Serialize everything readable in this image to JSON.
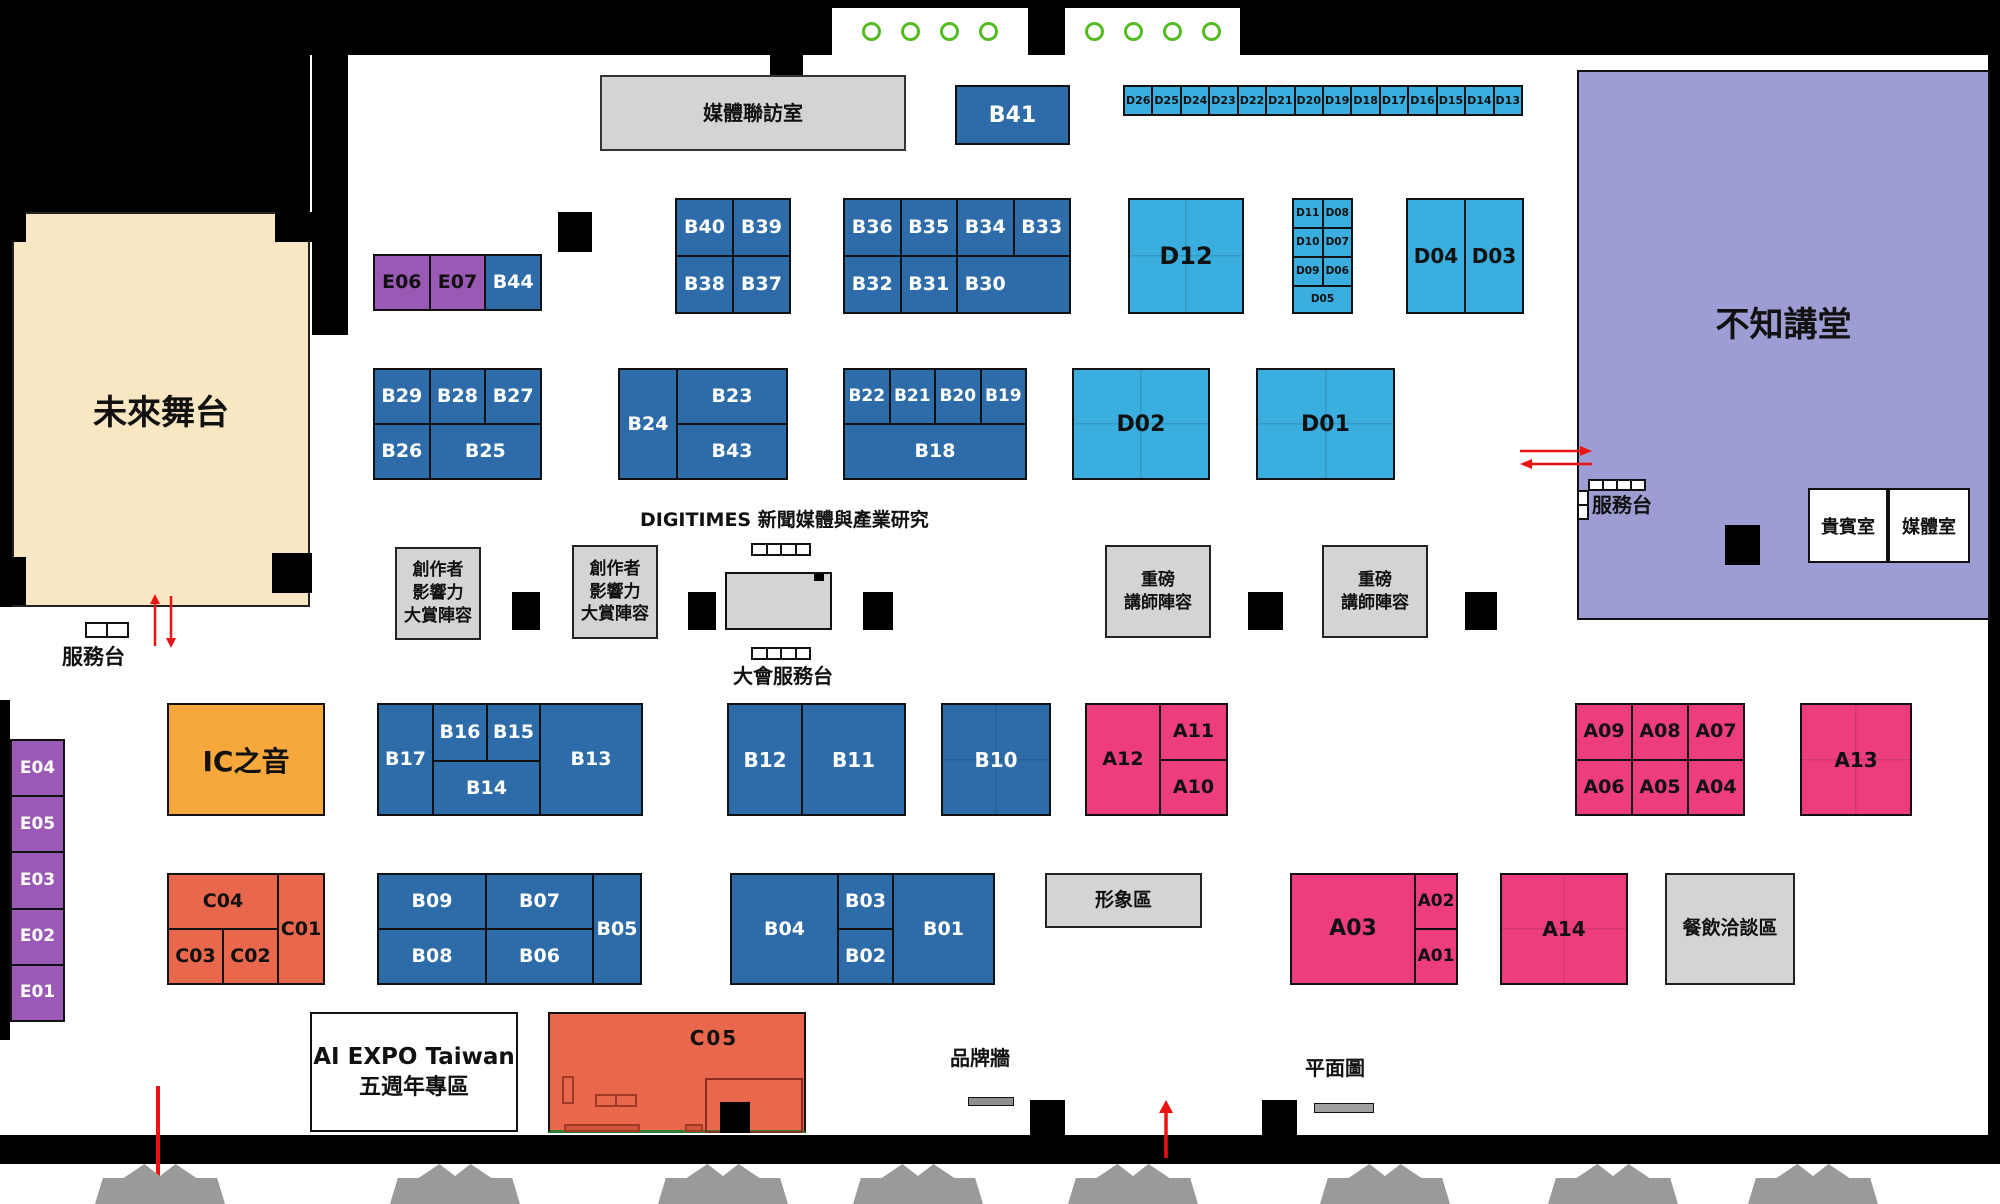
{
  "rooms": {
    "media_interview_room": "媒體聯訪室",
    "future_stage": "未來舞台",
    "lecture_hall": "不知講堂",
    "vip_room": "貴賓室",
    "media_room": "媒體室",
    "service_desk": "服務台",
    "hall_service_desk": "服務台",
    "main_service_desk": "大會服務台",
    "digitimes_area": "DIGITIMES 新聞媒體與產業研究",
    "creator_award_lines": [
      "創作者",
      "影響力",
      "大賞陣容"
    ],
    "keynote_speaker_lines": [
      "重磅",
      "講師陣容"
    ],
    "ic_voice": "IC之音",
    "image_area": "形象區",
    "dining_area": "餐飲洽談區",
    "anniversary_lines": [
      "AI EXPO Taiwan",
      "五週年專區"
    ],
    "brand_wall": "品牌牆",
    "floor_plan": "平面圖"
  },
  "booths": {
    "d_strip": [
      "D26",
      "D25",
      "D24",
      "D23",
      "D22",
      "D21",
      "D20",
      "D19",
      "D18",
      "D17",
      "D16",
      "D15",
      "D14",
      "D13"
    ],
    "b41": "B41",
    "b40_block": [
      "B40",
      "B39",
      "B38",
      "B37"
    ],
    "b36_block": [
      "B36",
      "B35",
      "B34",
      "B33",
      "B32",
      "B31",
      "B30"
    ],
    "d12": "D12",
    "d_mini": [
      "D11",
      "D08",
      "D10",
      "D07",
      "D09",
      "D06",
      "D05"
    ],
    "d04_block": [
      "D04",
      "D03"
    ],
    "e_row": [
      "E06",
      "E07",
      "B44"
    ],
    "b29_block": [
      "B29",
      "B28",
      "B27",
      "B26",
      "B25"
    ],
    "b24_block": [
      "B24",
      "B23",
      "B43"
    ],
    "b22_block": [
      "B22",
      "B21",
      "B20",
      "B19",
      "B18"
    ],
    "d02": "D02",
    "d01": "D01",
    "b17_block": [
      "B17",
      "B16",
      "B15",
      "B14",
      "B13"
    ],
    "b12_block": [
      "B12",
      "B11"
    ],
    "b10": "B10",
    "a12_block": [
      "A12",
      "A11",
      "A10"
    ],
    "a09_block": [
      "A09",
      "A08",
      "A07",
      "A06",
      "A05",
      "A04"
    ],
    "a13": "A13",
    "e_column": [
      "E04",
      "E05",
      "E03",
      "E02",
      "E01"
    ],
    "c_block": [
      "C04",
      "C01",
      "C03",
      "C02"
    ],
    "b09_block": [
      "B09",
      "B07",
      "B05",
      "B08",
      "B06"
    ],
    "b04_block": [
      "B04",
      "B03",
      "B02",
      "B01"
    ],
    "a03_block": [
      "A03",
      "A02",
      "A01"
    ],
    "a14": "A14",
    "c05": "C05"
  },
  "colors": {
    "booth_blue": "#2d6ca8",
    "booth_cyan": "#3aaede",
    "booth_pink": "#ee3d7f",
    "booth_purple": "#9b59b6",
    "booth_salmon": "#e8674d",
    "booth_orange": "#f6a83c",
    "stage_cream": "#f8e7c2",
    "hall_purple": "#9e9dd3",
    "info_gray": "#d4d4d4",
    "accent_red": "#ee1111",
    "circle_green": "#55bb22",
    "entry_gray": "#9a9a9a"
  }
}
